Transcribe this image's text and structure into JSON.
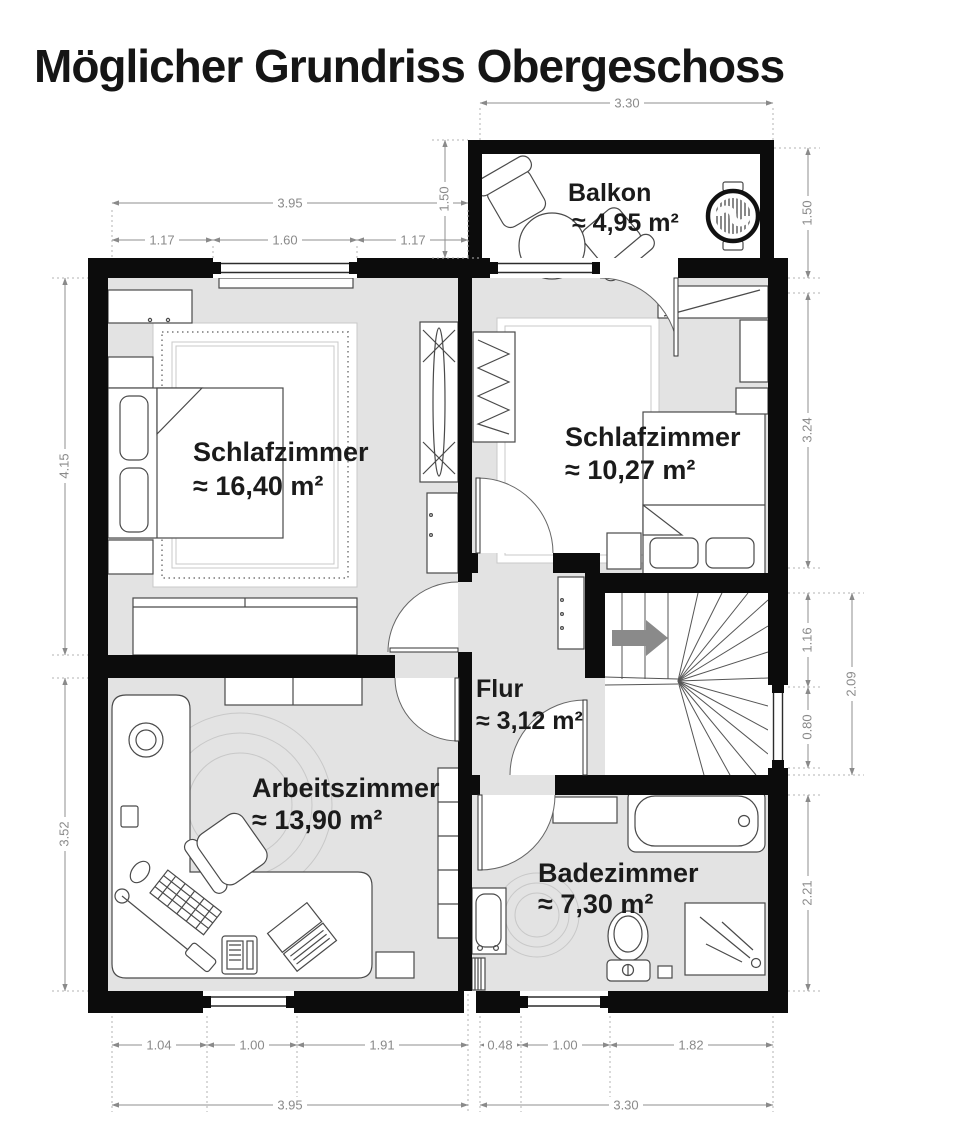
{
  "title": "Möglicher Grundriss Obergeschoss",
  "rooms": [
    {
      "id": "balkon",
      "name": "Balkon",
      "area": "≈ 4,95 m²"
    },
    {
      "id": "schlafzimmer-1",
      "name": "Schlafzimmer",
      "area": "≈ 16,40 m²"
    },
    {
      "id": "schlafzimmer-2",
      "name": "Schlafzimmer",
      "area": "≈ 10,27 m²"
    },
    {
      "id": "flur",
      "name": "Flur",
      "area": "≈ 3,12 m²"
    },
    {
      "id": "arbeitszimmer",
      "name": "Arbeitszimmer",
      "area": "≈ 13,90 m²"
    },
    {
      "id": "badezimmer",
      "name": "Badezimmer",
      "area": "≈ 7,30 m²"
    }
  ],
  "dimensions": {
    "balcony_width_top": "3.30",
    "left_width_total_top": "3.95",
    "left_seg_a": "1.17",
    "left_seg_b": "1.60",
    "left_seg_c": "1.17",
    "balcony_depth_left": "1.50",
    "balcony_depth_right": "1.50",
    "bedroom2_height": "3.24",
    "stairs_upper": "1.16",
    "stairs_window": "0.80",
    "stairs_total": "2.09",
    "bath_height": "2.21",
    "bedroom1_height": "4.15",
    "study_height": "3.52",
    "bottom_a": "1.04",
    "bottom_b": "1.00",
    "bottom_c": "1.91",
    "bottom_d": "0.48",
    "bottom_e": "1.00",
    "bottom_f": "1.82",
    "left_width_total_bottom": "3.95",
    "right_width_total_bottom": "3.30"
  },
  "colors": {
    "wall": "#0c0c0c",
    "floor": "#e3e3e3",
    "dimension": "#8a8a8a",
    "label": "#1b1b1b",
    "stairs_arrow": "#8a8a8a"
  }
}
